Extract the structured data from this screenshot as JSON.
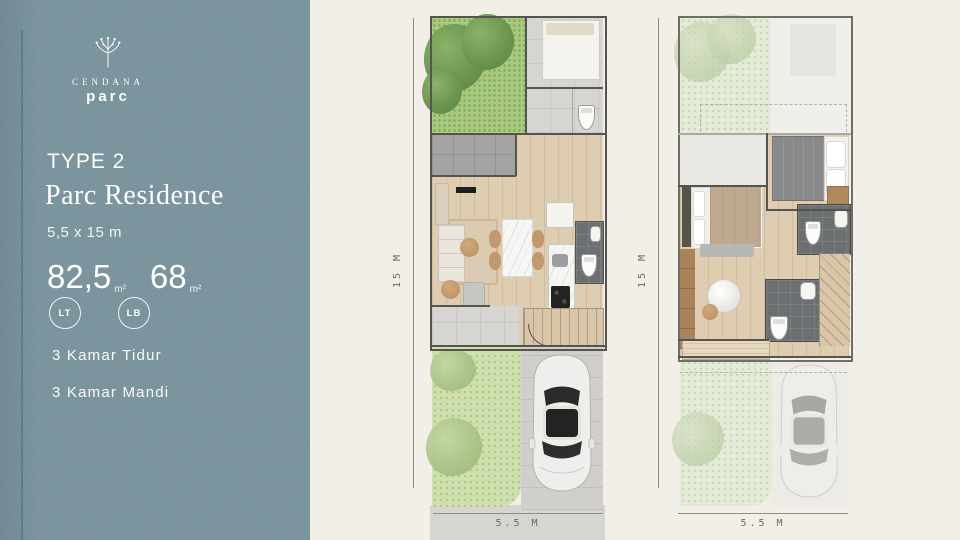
{
  "brand": {
    "name": "CENDANA",
    "sub": "parc"
  },
  "panel": {
    "type_label": "TYPE 2",
    "title": "Parc Residence",
    "size": "5,5 x 15 m",
    "areas": [
      {
        "value": "82,5",
        "unit": "m²",
        "badge": "LT"
      },
      {
        "value": "68",
        "unit": "m²",
        "badge": "LB"
      }
    ],
    "features": [
      "3 Kamar Tidur",
      "3 Kamar Mandi"
    ]
  },
  "plans": {
    "ground": {
      "height_label": "15 M",
      "width_label": "5.5 M"
    },
    "upper": {
      "height_label": "15 M",
      "width_label": "5.5 M"
    }
  },
  "colors": {
    "sidebar_bg": "#7d98a2",
    "content_bg": "#f1efe8",
    "text_light": "#ffffff",
    "wall": "#55544e",
    "grass": "#a8c97e",
    "grass_front": "#cfe0ae",
    "wood_floor": "#dfcdb2",
    "tile_gray": "#d6d5d2",
    "bath_tile": "#6b6f71",
    "dimension_text": "#6b6a62"
  }
}
